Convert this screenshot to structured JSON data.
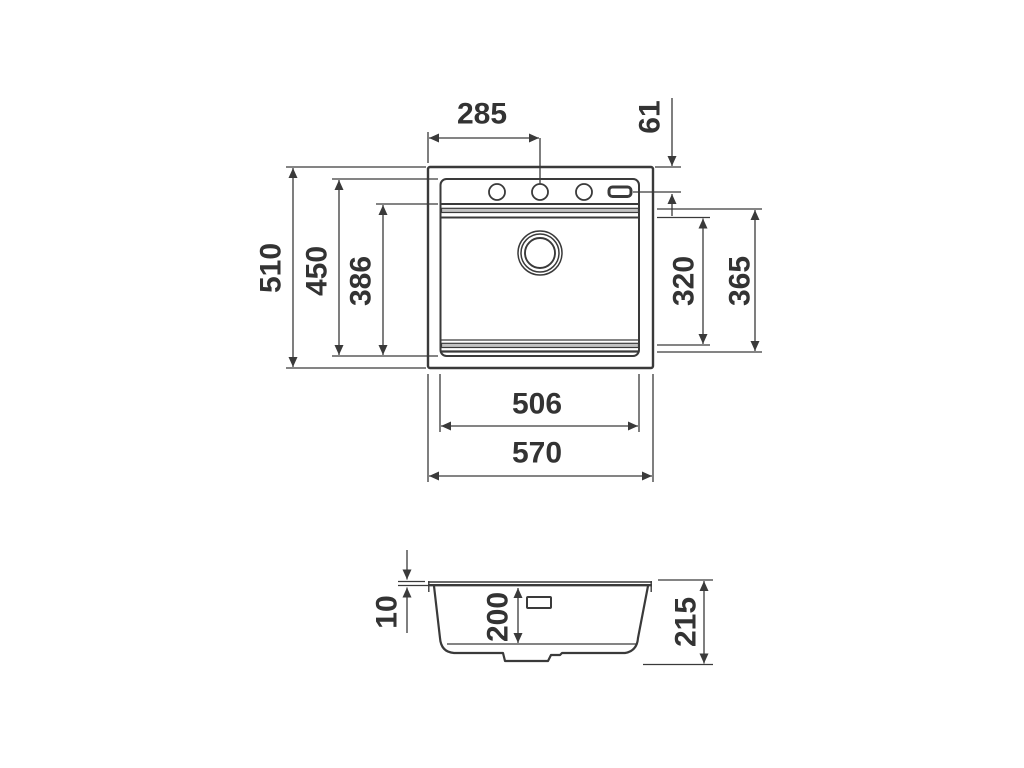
{
  "drawing": {
    "kind": "kitchen-sink-installation-drawing",
    "colors": {
      "line": "#3a3a3a",
      "text": "#333333",
      "background": "#ffffff",
      "band_fill": "#c2c2c2"
    },
    "top_view": {
      "dims": {
        "faucet_offset": "285",
        "faucet_inset": "61",
        "overall_depth": "510",
        "inner_depth": "450",
        "front_to_bowl_depth": "386",
        "bowl_depth_inner": "320",
        "bowl_depth_outer": "365",
        "inner_width": "506",
        "overall_width": "570"
      }
    },
    "section_view": {
      "dims": {
        "rim_height": "10",
        "bowl_depth": "200",
        "overall_height": "215"
      }
    }
  }
}
